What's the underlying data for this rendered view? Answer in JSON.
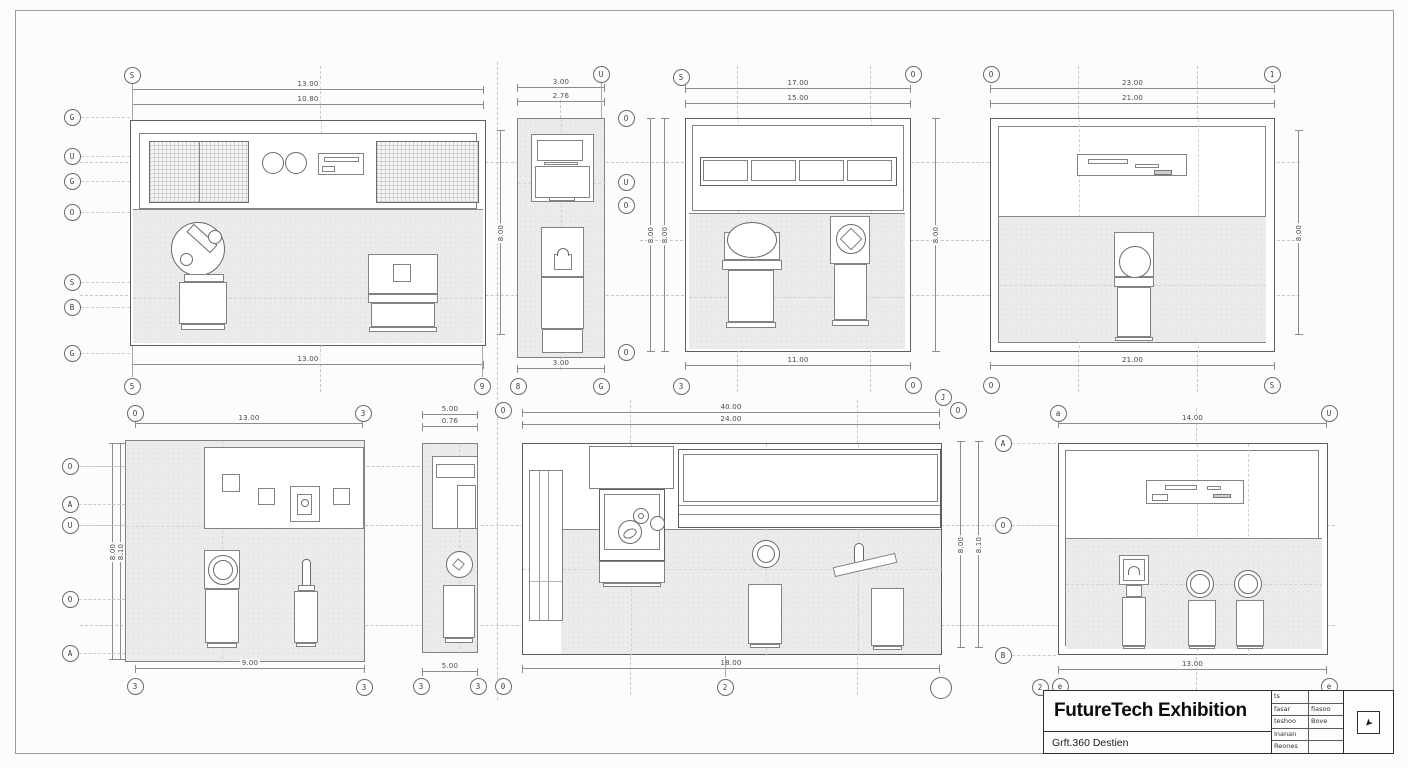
{
  "title_block": {
    "title": "FutureTech Exhibition",
    "subtitle": "Grft.360 Destien",
    "table": {
      "r1c1": "ts",
      "r1c2": "",
      "r2c1": "fasar",
      "r2c2": "fiasoo",
      "r3c1": "teshoo",
      "r3c2": "Bove",
      "r4c1": "Inanan",
      "r4c2": "",
      "r5c1": "Reones",
      "r5c2": ""
    }
  },
  "icons": {
    "cursor": "➤"
  },
  "dims": {
    "a_t1": "13.00",
    "a_t2": "10.80",
    "a_b": "13.00",
    "a_r": "8.00",
    "b_t1": "3.00",
    "b_t2": "2.76",
    "b_b": "3.00",
    "b_r": "8.00",
    "c_t1": "17.00",
    "c_t2": "15.00",
    "c_b": "11.00",
    "c_l": "8.00",
    "c_r": "8.00",
    "d_t1": "23.00",
    "d_t2": "21.00",
    "d_b": "21.00",
    "d_r": "8.00",
    "e_t": "13.00",
    "e_b": "9.00",
    "e_l1": "8.00",
    "e_l2": "8.10",
    "f_t1": "5.00",
    "f_t2": "0.76",
    "f_b": "5.00",
    "g_t1": "40.00",
    "g_t2": "24.00",
    "g_b": "18.00",
    "g_r1": "8.00",
    "g_r2": "8.10",
    "h_t": "14.00",
    "h_b": "13.00"
  },
  "bubbles": {
    "a_top": "S",
    "a_l0": "G",
    "a_l1": "U",
    "a_l2": "G",
    "a_l3": "O",
    "a_l4": "S",
    "a_l5": "B",
    "a_l6": "G",
    "a_b0": "5",
    "a_b1": "9",
    "b_top": "U",
    "b_r0": "O",
    "b_r1": "U",
    "b_r2": "O",
    "b_r3": "O",
    "b_b0": "8",
    "b_b1": "G",
    "c_tl": "5",
    "c_tr": "O",
    "c_bl": "3",
    "c_br": "O",
    "d_tl": "O",
    "d_tr": "1",
    "d_bl": "O",
    "d_br": "S",
    "e_t0": "O",
    "e_t1": "3",
    "e_l0": "O",
    "e_l1": "A",
    "e_l2": "U",
    "e_l3": "O",
    "e_l4": "A",
    "e_b0": "3",
    "e_b1": "3",
    "f_t0": "O",
    "f_b0": "3",
    "f_b1": "3",
    "f_b2": "0",
    "g_t0": "J",
    "g_t1": "O",
    "g_b0": "2",
    "h_t0": "a",
    "h_t1": "U",
    "h_l0": "A",
    "h_l1": "O",
    "h_l2": "B",
    "h_b0": "2",
    "h_b1": "e",
    "h_b2": "e"
  }
}
